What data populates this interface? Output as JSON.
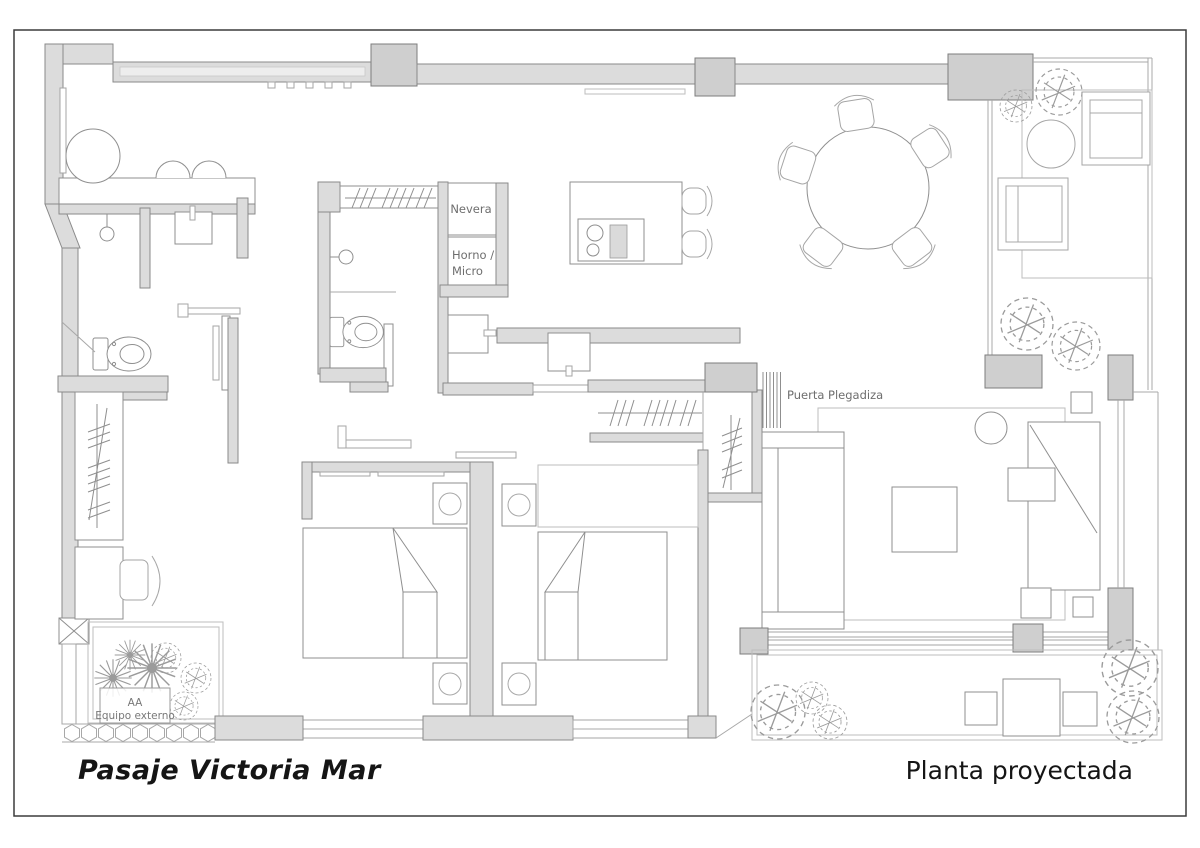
{
  "document": {
    "type": "architectural floor plan",
    "sheet_border_color": "#3c3c3c",
    "background": "#ffffff"
  },
  "footer": {
    "title": "Pasaje Victoria Mar",
    "subtitle": "Planta proyectada"
  },
  "plan_labels": {
    "fridge": "Nevera",
    "oven_line1": "Horno /",
    "oven_line2": "Micro",
    "folding_door": "Puerta Plegadiza",
    "ac_line1": "AA",
    "ac_line2": "Equipo externo"
  },
  "colors": {
    "wall_fill": "#dcdcdc",
    "wall_stroke": "#8a8a8a",
    "furniture_stroke": "#8f8f8f",
    "plant_stroke": "#9b9b9b",
    "plan_label_color": "#6e6e6e",
    "title_color": "#151515"
  }
}
